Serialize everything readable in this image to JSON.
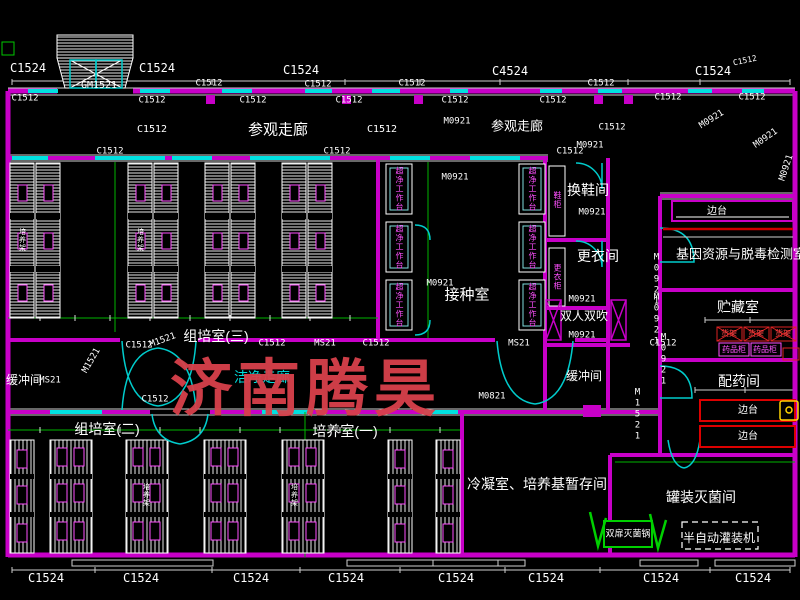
{
  "drawing": {
    "type": "CAD floor plan",
    "watermark": {
      "text": "济南腾昊",
      "color": "#d8414b"
    },
    "colors": {
      "background": "#000000",
      "wall": "#c800c8",
      "window": "#00e0e0",
      "dimension": "#00b400",
      "lines": "#ffffff",
      "equipment_text": "#ff4fff",
      "red_detail": "#dd2222",
      "watermark": "#d8414b"
    },
    "rooms": [
      "参观走廊",
      "组培室(三)",
      "接种室",
      "换鞋间",
      "更衣间",
      "双人双吹",
      "缓冲间",
      "洁净走廊",
      "组培室(二)",
      "培养室(一)",
      "冷凝室、培养基暂存间",
      "罐装灭菌间",
      "配药间",
      "贮藏室",
      "基因资源与脱毒检测室"
    ],
    "equipment": [
      "超净工作台",
      "鞋柜",
      "更衣柜",
      "培养架",
      "货架",
      "药品柜",
      "边台",
      "双扉灭菌锅",
      "半自动灌装机"
    ]
  },
  "labels": [
    {
      "t": "C1524",
      "x": 28,
      "y": 68,
      "s": 12
    },
    {
      "t": "C1524",
      "x": 157,
      "y": 68,
      "s": 12
    },
    {
      "t": "GM1521",
      "x": 99,
      "y": 86,
      "s": 10
    },
    {
      "t": "C1524",
      "x": 301,
      "y": 70,
      "s": 12
    },
    {
      "t": "C4524",
      "x": 510,
      "y": 71,
      "s": 12
    },
    {
      "t": "C1524",
      "x": 713,
      "y": 71,
      "s": 12
    },
    {
      "t": "C1512",
      "x": 745,
      "y": 61,
      "s": 8,
      "r": -12
    },
    {
      "t": "C1512",
      "x": 25,
      "y": 99
    },
    {
      "t": "C1512",
      "x": 152,
      "y": 101
    },
    {
      "t": "C1512",
      "x": 209,
      "y": 84
    },
    {
      "t": "C1512",
      "x": 318,
      "y": 85
    },
    {
      "t": "C1512",
      "x": 412,
      "y": 84
    },
    {
      "t": "C1512",
      "x": 601,
      "y": 84
    },
    {
      "t": "C1512",
      "x": 253,
      "y": 101
    },
    {
      "t": "C1512",
      "x": 349,
      "y": 101
    },
    {
      "t": "C1512",
      "x": 455,
      "y": 101
    },
    {
      "t": "C1512",
      "x": 553,
      "y": 101
    },
    {
      "t": "C1512",
      "x": 668,
      "y": 98
    },
    {
      "t": "C1512",
      "x": 752,
      "y": 98
    },
    {
      "t": "参观走廊",
      "x": 278,
      "y": 130,
      "s": 15,
      "cn": 1
    },
    {
      "t": "C1512",
      "x": 152,
      "y": 130,
      "s": 10
    },
    {
      "t": "C1512",
      "x": 382,
      "y": 130,
      "s": 10
    },
    {
      "t": "M0921",
      "x": 457,
      "y": 122
    },
    {
      "t": "参观走廊",
      "x": 517,
      "y": 126,
      "s": 13,
      "cn": 1
    },
    {
      "t": "C1512",
      "x": 612,
      "y": 128
    },
    {
      "t": "M0921",
      "x": 712,
      "y": 120,
      "r": -32
    },
    {
      "t": "M0921",
      "x": 766,
      "y": 139,
      "r": -35
    },
    {
      "t": "M0921",
      "x": 787,
      "y": 168,
      "r": -72
    },
    {
      "t": "C1512",
      "x": 110,
      "y": 152
    },
    {
      "t": "C1512",
      "x": 337,
      "y": 152
    },
    {
      "t": "C1512",
      "x": 570,
      "y": 152
    },
    {
      "t": "M0921",
      "x": 590,
      "y": 146
    },
    {
      "t": "M0921",
      "x": 455,
      "y": 178
    },
    {
      "t": "接种室",
      "x": 467,
      "y": 295,
      "s": 15,
      "cn": 1
    },
    {
      "t": "M0921",
      "x": 440,
      "y": 284
    },
    {
      "t": "换鞋间",
      "x": 588,
      "y": 190,
      "s": 14,
      "cn": 1
    },
    {
      "t": "M0921",
      "x": 592,
      "y": 213
    },
    {
      "t": "更衣间",
      "x": 598,
      "y": 256,
      "s": 14,
      "cn": 1
    },
    {
      "t": "M0921",
      "x": 582,
      "y": 300
    },
    {
      "t": "双人双吹",
      "x": 584,
      "y": 316,
      "s": 12,
      "cn": 1
    },
    {
      "t": "M0921",
      "x": 582,
      "y": 336
    },
    {
      "t": "M0921",
      "x": 656,
      "y": 280,
      "v": 1
    },
    {
      "t": "M0921",
      "x": 656,
      "y": 320,
      "v": 1
    },
    {
      "t": "组培室(三)",
      "x": 216,
      "y": 336,
      "s": 14,
      "cn": 1
    },
    {
      "t": "M1521",
      "x": 163,
      "y": 341,
      "r": -20
    },
    {
      "t": "C1512",
      "x": 272,
      "y": 344
    },
    {
      "t": "MS21",
      "x": 325,
      "y": 344
    },
    {
      "t": "C1512",
      "x": 376,
      "y": 344
    },
    {
      "t": "MS21",
      "x": 519,
      "y": 344
    },
    {
      "t": "C1512",
      "x": 663,
      "y": 344
    },
    {
      "t": "C1512",
      "x": 139,
      "y": 346
    },
    {
      "t": "M1521",
      "x": 92,
      "y": 361,
      "r": -60
    },
    {
      "t": "缓冲间",
      "x": 24,
      "y": 380,
      "s": 12,
      "cn": 1
    },
    {
      "t": "MS21",
      "x": 50,
      "y": 381
    },
    {
      "t": "洁净走廊",
      "x": 262,
      "y": 377,
      "s": 14,
      "c": "#00dddd",
      "cn": 1
    },
    {
      "t": "C1512",
      "x": 155,
      "y": 400
    },
    {
      "t": "缓冲间",
      "x": 584,
      "y": 376,
      "s": 12,
      "cn": 1
    },
    {
      "t": "M0821",
      "x": 492,
      "y": 397
    },
    {
      "t": "M1521",
      "x": 637,
      "y": 415,
      "v": 1
    },
    {
      "t": "M0921",
      "x": 663,
      "y": 360,
      "v": 1
    },
    {
      "t": "组培室(二)",
      "x": 107,
      "y": 429,
      "s": 14,
      "cn": 1
    },
    {
      "t": "培养室(一)",
      "x": 345,
      "y": 431,
      "s": 14,
      "cn": 1
    },
    {
      "t": "冷凝室、培养基暂存间",
      "x": 537,
      "y": 484,
      "s": 14,
      "cn": 1
    },
    {
      "t": "双扉灭菌锅",
      "x": 628,
      "y": 534,
      "s": 9,
      "cn": 1
    },
    {
      "t": "罐装灭菌间",
      "x": 701,
      "y": 497,
      "s": 14,
      "cn": 1
    },
    {
      "t": "半自动灌装机",
      "x": 719,
      "y": 538,
      "s": 12,
      "cn": 1
    },
    {
      "t": "边台",
      "x": 717,
      "y": 212,
      "s": 10,
      "cn": 1
    },
    {
      "t": "基因资源与脱毒检测室",
      "x": 741,
      "y": 254,
      "s": 13,
      "cn": 1
    },
    {
      "t": "贮藏室",
      "x": 738,
      "y": 307,
      "s": 14,
      "cn": 1
    },
    {
      "t": "货架",
      "x": 729,
      "y": 334,
      "s": 8,
      "c": "#ff4444",
      "cn": 1
    },
    {
      "t": "货架",
      "x": 756,
      "y": 334,
      "s": 8,
      "c": "#ff4444",
      "cn": 1
    },
    {
      "t": "货架",
      "x": 783,
      "y": 334,
      "s": 8,
      "c": "#ff4444",
      "cn": 1
    },
    {
      "t": "药品柜",
      "x": 734,
      "y": 350,
      "s": 8,
      "c": "#ff55ff",
      "cn": 1
    },
    {
      "t": "药品柜",
      "x": 765,
      "y": 350,
      "s": 8,
      "c": "#ff55ff",
      "cn": 1
    },
    {
      "t": "配药间",
      "x": 739,
      "y": 381,
      "s": 14,
      "cn": 1
    },
    {
      "t": "边台",
      "x": 748,
      "y": 411,
      "s": 10,
      "cn": 1
    },
    {
      "t": "边台",
      "x": 748,
      "y": 437,
      "s": 10,
      "cn": 1
    },
    {
      "t": "C1524",
      "x": 46,
      "y": 578,
      "s": 12
    },
    {
      "t": "C1524",
      "x": 141,
      "y": 578,
      "s": 12
    },
    {
      "t": "C1524",
      "x": 251,
      "y": 578,
      "s": 12
    },
    {
      "t": "C1524",
      "x": 346,
      "y": 578,
      "s": 12
    },
    {
      "t": "C1524",
      "x": 456,
      "y": 578,
      "s": 12
    },
    {
      "t": "C1524",
      "x": 546,
      "y": 578,
      "s": 12
    },
    {
      "t": "C1524",
      "x": 661,
      "y": 578,
      "s": 12
    },
    {
      "t": "C1524",
      "x": 753,
      "y": 578,
      "s": 12
    },
    {
      "t": "超净工作台",
      "x": 399,
      "y": 189,
      "v": 1,
      "s": 8,
      "c": "#ff4fff",
      "cn": 1
    },
    {
      "t": "超净工作台",
      "x": 399,
      "y": 247,
      "v": 1,
      "s": 8,
      "c": "#ff4fff",
      "cn": 1
    },
    {
      "t": "超净工作台",
      "x": 399,
      "y": 305,
      "v": 1,
      "s": 8,
      "c": "#ff4fff",
      "cn": 1
    },
    {
      "t": "超净工作台",
      "x": 532,
      "y": 189,
      "v": 1,
      "s": 8,
      "c": "#ff4fff",
      "cn": 1
    },
    {
      "t": "超净工作台",
      "x": 532,
      "y": 247,
      "v": 1,
      "s": 8,
      "c": "#ff4fff",
      "cn": 1
    },
    {
      "t": "超净工作台",
      "x": 532,
      "y": 305,
      "v": 1,
      "s": 8,
      "c": "#ff4fff",
      "cn": 1
    },
    {
      "t": "鞋柜",
      "x": 557,
      "y": 200,
      "v": 1,
      "s": 8,
      "c": "#ff4fff",
      "cn": 1
    },
    {
      "t": "更衣柜",
      "x": 557,
      "y": 277,
      "v": 1,
      "s": 8,
      "c": "#ff4fff",
      "cn": 1
    },
    {
      "t": "培养架",
      "x": 22,
      "y": 240,
      "v": 1,
      "s": 7,
      "cn": 1
    },
    {
      "t": "培养架",
      "x": 140,
      "y": 240,
      "v": 1,
      "s": 7,
      "cn": 1
    },
    {
      "t": "培养架",
      "x": 146,
      "y": 495,
      "v": 1,
      "s": 7,
      "cn": 1
    },
    {
      "t": "培养架",
      "x": 294,
      "y": 495,
      "v": 1,
      "s": 7,
      "cn": 1
    }
  ]
}
